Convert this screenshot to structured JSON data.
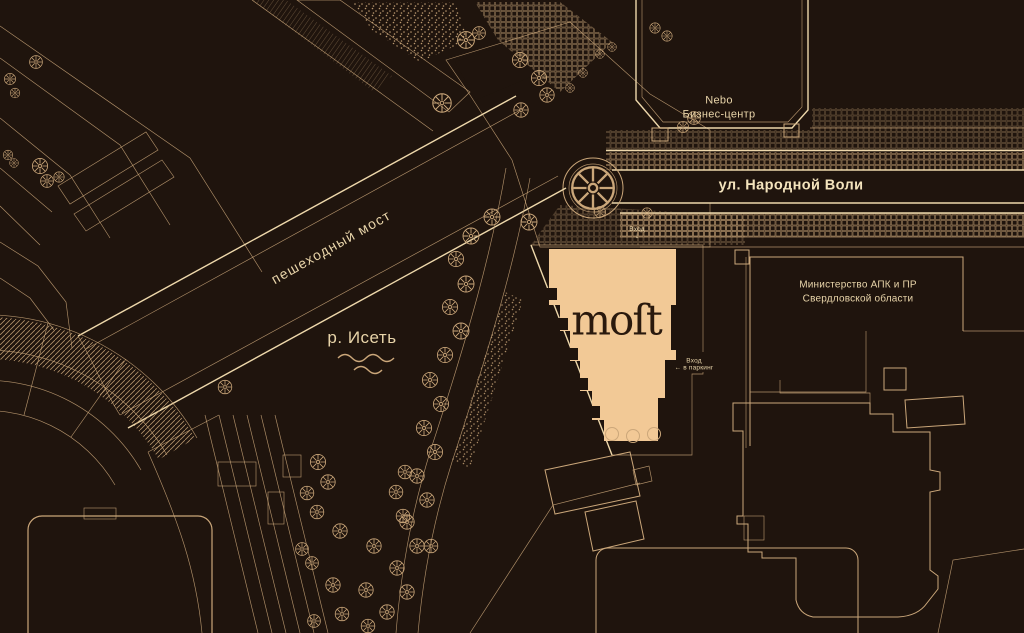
{
  "map": {
    "project_logo": "moſt",
    "labels": {
      "nebo_line1": "Nebo",
      "nebo_line2": "Бизнес-центр",
      "street": "ул. Народной Воли",
      "bridge": "пешеходный мост",
      "river": "р. Исеть",
      "ministry_line1": "Министерство АПК и ПР",
      "ministry_line2": "Свердловской области",
      "entrance_label": "Вход",
      "entrance_arrow": "↓",
      "parking_arrow": "←",
      "parking_line1": "Вход",
      "parking_line2": "в паркинг"
    },
    "colors": {
      "background": "#1f140d",
      "line": "#cba77a",
      "line_bright": "#eed8ab",
      "label": "#e8d4a9",
      "label_bright": "#f4e4bd",
      "building_fill": "#f2c996",
      "logo": "#2a190d"
    }
  }
}
